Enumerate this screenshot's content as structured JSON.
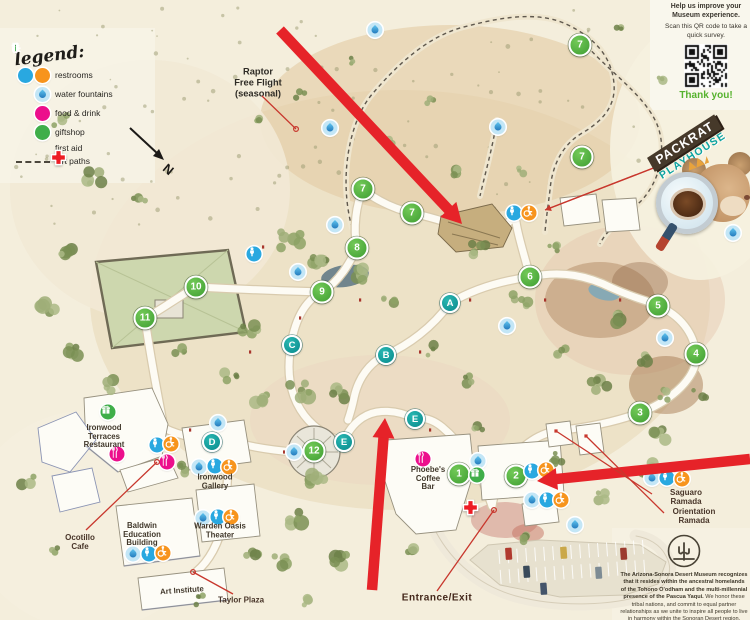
{
  "survey": {
    "help": "Help us improve your Museum experience.",
    "scan": "Scan this QR code to take a quick survey.",
    "thanks": "Thank you!"
  },
  "packrat": {
    "top": "PACKRAT",
    "bottom": "PLAYHOUSE"
  },
  "legend": {
    "title": "legend:",
    "items": [
      {
        "label": "restrooms",
        "icons": "male wheel"
      },
      {
        "label": "water fountains",
        "icons": "water"
      },
      {
        "label": "food & drink",
        "icons": "food"
      },
      {
        "label": "giftshop",
        "icons": "gift"
      },
      {
        "label": "first aid",
        "icons": "aid"
      },
      {
        "label": "dirt paths",
        "icons": "dash"
      }
    ]
  },
  "north": {
    "label": "N"
  },
  "acknowledgment": {
    "bold": "The Arizona-Sonora Desert Museum recognizes that it resides within the ancestral homelands of the Tohono O'odham and the multi-millennial presence of the Pascua Yaqui.",
    "rest": " We honor these tribal nations, and commit to equal partner relationships as we unite to inspire all people to live in harmony within the Sonoran Desert region."
  },
  "map": {
    "labels": [
      {
        "text": "Raptor\nFree Flight\n(seasonal)",
        "x": 258,
        "y": 83,
        "cls": "poi"
      },
      {
        "text": "Ironwood\nTerraces\nRestaurant",
        "x": 104,
        "y": 437,
        "cls": "building"
      },
      {
        "text": "Ocotillo\nCafe",
        "x": 80,
        "y": 543,
        "cls": "call"
      },
      {
        "text": "Baldwin\nEducation\nBuilding",
        "x": 142,
        "y": 535,
        "cls": "building"
      },
      {
        "text": "Ironwood\nGallery",
        "x": 215,
        "y": 482,
        "cls": "building"
      },
      {
        "text": "Warden Oasis\nTheater",
        "x": 220,
        "y": 531,
        "cls": "building"
      },
      {
        "text": "Art Institute",
        "x": 182,
        "y": 591,
        "cls": "building",
        "rot": -4
      },
      {
        "text": "Taylor Plaza",
        "x": 241,
        "y": 601,
        "cls": "call"
      },
      {
        "text": "Phoebe's\nCoffee\nBar",
        "x": 428,
        "y": 479,
        "cls": "building"
      },
      {
        "text": "Entrance/Exit",
        "x": 437,
        "y": 598,
        "cls": "entrance"
      },
      {
        "text": "Saguaro Ramada",
        "x": 686,
        "y": 498,
        "cls": "call"
      },
      {
        "text": "Orientation Ramada",
        "x": 694,
        "y": 517,
        "cls": "call"
      }
    ],
    "markers": {
      "numbers": [
        {
          "n": "1",
          "x": 459,
          "y": 474
        },
        {
          "n": "2",
          "x": 516,
          "y": 476
        },
        {
          "n": "3",
          "x": 640,
          "y": 413
        },
        {
          "n": "4",
          "x": 696,
          "y": 354
        },
        {
          "n": "5",
          "x": 658,
          "y": 306
        },
        {
          "n": "6",
          "x": 530,
          "y": 277
        },
        {
          "n": "7",
          "x": 363,
          "y": 189
        },
        {
          "n": "7",
          "x": 412,
          "y": 213
        },
        {
          "n": "7",
          "x": 580,
          "y": 45
        },
        {
          "n": "7",
          "x": 582,
          "y": 157
        },
        {
          "n": "8",
          "x": 357,
          "y": 248
        },
        {
          "n": "9",
          "x": 322,
          "y": 292
        },
        {
          "n": "10",
          "x": 196,
          "y": 287
        },
        {
          "n": "11",
          "x": 145,
          "y": 318
        },
        {
          "n": "12",
          "x": 314,
          "y": 451
        }
      ],
      "letters": [
        {
          "l": "A",
          "x": 450,
          "y": 303
        },
        {
          "l": "B",
          "x": 386,
          "y": 355
        },
        {
          "l": "C",
          "x": 292,
          "y": 345
        },
        {
          "l": "D",
          "x": 212,
          "y": 442
        },
        {
          "l": "E",
          "x": 344,
          "y": 442
        },
        {
          "l": "E",
          "x": 415,
          "y": 419
        }
      ],
      "icons": [
        {
          "t": "water",
          "x": 375,
          "y": 30
        },
        {
          "t": "water",
          "x": 330,
          "y": 128
        },
        {
          "t": "water",
          "x": 498,
          "y": 127
        },
        {
          "t": "water",
          "x": 335,
          "y": 225
        },
        {
          "t": "water",
          "x": 298,
          "y": 272
        },
        {
          "t": "water",
          "x": 507,
          "y": 326
        },
        {
          "t": "water",
          "x": 665,
          "y": 338
        },
        {
          "t": "water",
          "x": 733,
          "y": 233
        },
        {
          "t": "water",
          "x": 294,
          "y": 452
        },
        {
          "t": "water",
          "x": 218,
          "y": 423
        },
        {
          "t": "water",
          "x": 199,
          "y": 467
        },
        {
          "t": "water",
          "x": 133,
          "y": 554
        },
        {
          "t": "water",
          "x": 203,
          "y": 518
        },
        {
          "t": "water",
          "x": 478,
          "y": 461
        },
        {
          "t": "water",
          "x": 532,
          "y": 500
        },
        {
          "t": "water",
          "x": 575,
          "y": 525
        },
        {
          "t": "water",
          "x": 652,
          "y": 478
        },
        {
          "t": "male",
          "x": 514,
          "y": 213
        },
        {
          "t": "wheel",
          "x": 529,
          "y": 213
        },
        {
          "t": "male",
          "x": 254,
          "y": 254
        },
        {
          "t": "male",
          "x": 157,
          "y": 445
        },
        {
          "t": "wheel",
          "x": 171,
          "y": 444
        },
        {
          "t": "male",
          "x": 215,
          "y": 466
        },
        {
          "t": "wheel",
          "x": 229,
          "y": 467
        },
        {
          "t": "male",
          "x": 149,
          "y": 554
        },
        {
          "t": "wheel",
          "x": 163,
          "y": 553
        },
        {
          "t": "male",
          "x": 218,
          "y": 517
        },
        {
          "t": "wheel",
          "x": 231,
          "y": 517
        },
        {
          "t": "male",
          "x": 532,
          "y": 471
        },
        {
          "t": "wheel",
          "x": 546,
          "y": 470
        },
        {
          "t": "male",
          "x": 547,
          "y": 500
        },
        {
          "t": "wheel",
          "x": 561,
          "y": 500
        },
        {
          "t": "male",
          "x": 667,
          "y": 478
        },
        {
          "t": "wheel",
          "x": 682,
          "y": 479
        },
        {
          "t": "food",
          "x": 117,
          "y": 454
        },
        {
          "t": "food",
          "x": 167,
          "y": 462
        },
        {
          "t": "food",
          "x": 423,
          "y": 459
        },
        {
          "t": "gift",
          "x": 108,
          "y": 412
        },
        {
          "t": "gift",
          "x": 477,
          "y": 475
        },
        {
          "t": "aid",
          "x": 462,
          "y": 499
        }
      ]
    },
    "arrows": [
      {
        "x1": 280,
        "y1": 30,
        "x2": 462,
        "y2": 224
      },
      {
        "x1": 372,
        "y1": 590,
        "x2": 385,
        "y2": 418
      },
      {
        "x1": 750,
        "y1": 459,
        "x2": 537,
        "y2": 481
      }
    ],
    "callouts": [
      {
        "x1": 262,
        "y1": 96,
        "x2": 296,
        "y2": 129,
        "end": "circle"
      },
      {
        "x1": 656,
        "y1": 167,
        "x2": 545,
        "y2": 210,
        "end": "arrow"
      },
      {
        "x1": 86,
        "y1": 530,
        "x2": 157,
        "y2": 462,
        "end": "circle"
      },
      {
        "x1": 233,
        "y1": 594,
        "x2": 193,
        "y2": 572,
        "end": "circle"
      },
      {
        "x1": 437,
        "y1": 591,
        "x2": 494,
        "y2": 510,
        "end": "circle"
      },
      {
        "x1": 652,
        "y1": 494,
        "x2": 556,
        "y2": 431,
        "end": "dot"
      },
      {
        "x1": 664,
        "y1": 513,
        "x2": 586,
        "y2": 436,
        "end": "dot"
      }
    ]
  },
  "colors": {
    "marker_green": "#4fae3d",
    "letter_teal": "#0ea5a5",
    "water_blue": "#29a8e0",
    "wheel_orange": "#f7941d",
    "food_pink": "#ec0f8c",
    "gift_green": "#3fae49",
    "aid_red": "#ed1c24",
    "arrow_red": "#e62329",
    "callout_red": "#c8372d",
    "thanks_green": "#56b22e"
  }
}
